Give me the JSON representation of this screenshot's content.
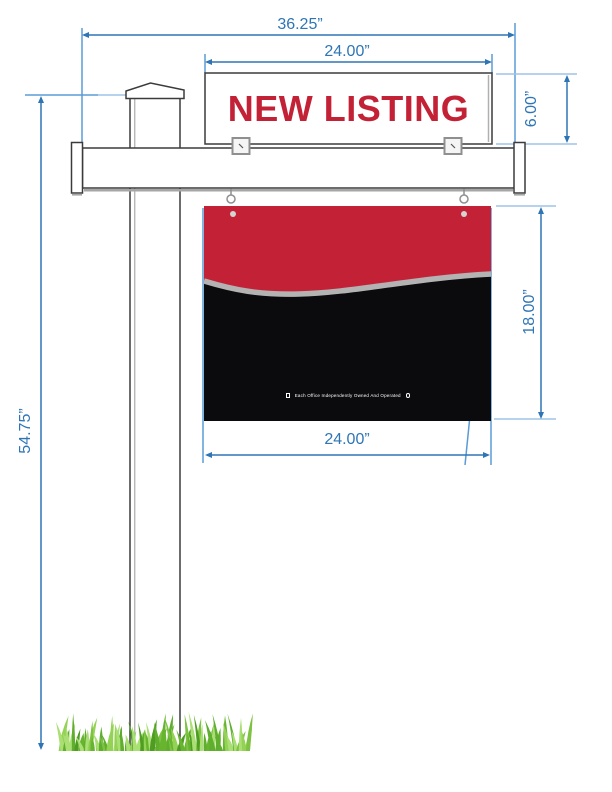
{
  "dimensions": {
    "overall_width": "36.25”",
    "rider_width": "24.00”",
    "rider_height": "6.00”",
    "panel_height": "18.00”",
    "panel_width": "24.00”",
    "overall_height": "54.75”"
  },
  "rider": {
    "text": "NEW LISTING"
  },
  "panel": {
    "disclaimer": "Each Office Independently Owned And Operated"
  },
  "icons": {
    "left": "realtor-icon",
    "right": "equal-housing-icon"
  },
  "colors": {
    "dimension_blue": "#2E75B6",
    "medium_blue": "#5B9BD5",
    "extension_blue": "#9DC3E6",
    "sign_red": "#C32236",
    "sign_black": "#0B0B0D",
    "wave_gray": "#B3B3B3",
    "grass_palette": [
      "#4e9c22",
      "#67b52f",
      "#7dc242",
      "#93d255",
      "#aadf73",
      "#5fae2e"
    ]
  }
}
